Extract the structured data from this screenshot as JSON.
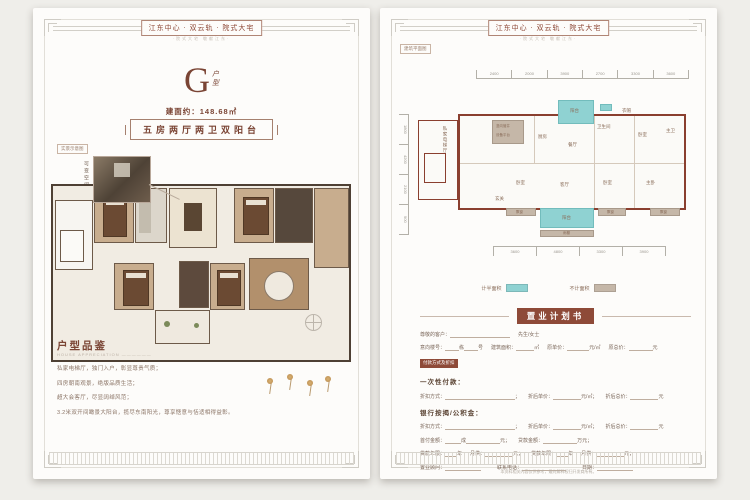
{
  "colors": {
    "accent": "#8e4a38",
    "cyan": "#8fd2d2",
    "tan": "#c5b7a8",
    "wall": "#8a3f2f"
  },
  "header": {
    "title": "江东中心 · 双云轨 · 院式大宅",
    "subtitle": "·院式大宅 敬献江东·"
  },
  "left_page": {
    "unit_letter": "G",
    "unit_char_1": "户",
    "unit_char_2": "型",
    "area": "建面约：148.68㎡",
    "desc": "五房两厅两卫双阳台",
    "inset_tag": "实景示意图",
    "inset_vertical": "可变空间",
    "appreciation_title": "户型品鉴",
    "appreciation_sub": "HOUSE APPRECIATION ——————",
    "bullets": [
      "私家电梯厅，独门入户，彰显尊贵气质；",
      "四房朝南观景，绝版品质生活；",
      "超大会客厅，尽显阔绰风范；",
      "3.2米双开间瞰景大阳台，揽尽东南阳光，尊享惬意与恬适相得益彰。"
    ]
  },
  "right_page": {
    "plan_tag": "建筑平面图",
    "rooms": {
      "elevator": "私家电梯厅",
      "equip_1": "竖向管井",
      "equip_2": "设备平台",
      "kitchen": "厨房",
      "dining": "餐厅",
      "balcony": "阳台",
      "bath": "卫生间",
      "cloak": "衣帽",
      "bedroom": "卧室",
      "master_bath": "主卫",
      "foyer": "玄关",
      "living": "客厅",
      "master_bed": "主卧",
      "bay": "飘窗",
      "canopy": "雨棚"
    },
    "dims_top": [
      "2400",
      "2000",
      "3900",
      "2700",
      "3300",
      "3600"
    ],
    "dims_bottom": [
      "3600",
      "4800",
      "3300",
      "3900"
    ],
    "dims_left": [
      "1800",
      "4200",
      "2100",
      "900"
    ],
    "legend": [
      {
        "label": "计半面积",
        "color": "#8fd2d2"
      },
      {
        "label": "不计面积",
        "color": "#c5b7a8"
      }
    ],
    "form": {
      "title": "置业计划书",
      "customer": "尊敬的客户：",
      "honorific": "先生/女士",
      "intent": "意向楼号：",
      "dong": "栋",
      "hao": "号",
      "area": "建筑面积：",
      "m2": "㎡",
      "price": "原单价：",
      "yuanm2": "元/㎡",
      "total": "原总价：",
      "yuan": "元",
      "pay_tag": "付款方式及折扣",
      "one_time": "一次性付款：",
      "discount": "折扣方式：",
      "semi": "；",
      "disc_price": "折后单价：",
      "yuanm2s": "元/㎡；",
      "disc_total": "折后总价：",
      "mortgage": "银行按揭/公积金：",
      "down": "首付金额：",
      "cheng": "成",
      "yuans": "元；",
      "loan_amt": "贷款金额：",
      "wan": "万元；",
      "years": "贷款年限：",
      "year": "年",
      "monthly": "月供：",
      "consultant": "置业顾问：",
      "phone": "联系电话：",
      "date": "日期："
    },
    "disclaimer": "本资料相关内容仅供参考，最终解释权归开发商所有。"
  }
}
